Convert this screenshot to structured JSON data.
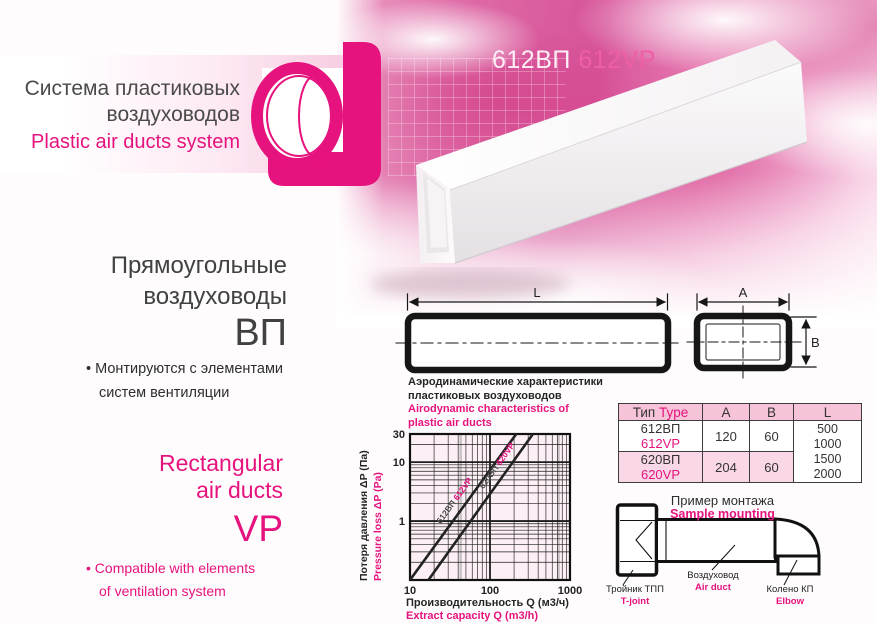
{
  "colors": {
    "accent": "#e6127d",
    "title_pink": "#ee5fa5",
    "dark": "#414141"
  },
  "header": {
    "title_ru_1": "Система пластиковых",
    "title_ru_2": "воздуховодов",
    "title_en": "Plastic air ducts system"
  },
  "product_title": {
    "ru": "612ВП",
    "en": "612VP"
  },
  "left": {
    "ru": {
      "h1": "Прямоугольные",
      "h2": "воздуховоды",
      "code": "ВП",
      "b1": "• Монтируются с элементами",
      "b2": "систем вентиляции"
    },
    "en": {
      "h1": "Rectangular",
      "h2": "air ducts",
      "code": "VP",
      "b1": "• Compatible with elements",
      "b2": "of ventilation system"
    }
  },
  "dimensions": {
    "L": "L",
    "A": "A",
    "B": "B"
  },
  "chart": {
    "title_ru1": "Аэродинамические характеристики",
    "title_ru2": "пластиковых воздуховодов",
    "title_en1": "Airodynamic characteristics of",
    "title_en2": "plastic air ducts"
  },
  "chart_data": {
    "type": "line",
    "title": "Аэродинамические характеристики пластиковых воздуховодов / Airodynamic characteristics of plastic air ducts",
    "x_axis": {
      "label_ru": "Производительность Q (м3/ч)",
      "label_en": "Extract capacity Q (m3/h)",
      "scale": "log",
      "range": [
        10,
        1000
      ],
      "ticks": [
        10,
        100,
        1000
      ]
    },
    "y_axis": {
      "label_ru": "Потеря давления ΔP (Па)",
      "label_en": "Pressure loss ΔP (Pa)",
      "scale": "log",
      "range": [
        0.1,
        30
      ],
      "ticks": [
        30,
        10,
        1
      ]
    },
    "grid": true,
    "legend_position": "on-line-labels",
    "series": [
      {
        "name_ru": "612ВП",
        "name_en": "612VP",
        "points": [
          [
            10,
            0.1
          ],
          [
            213,
            30
          ]
        ]
      },
      {
        "name_ru": "620ВП",
        "name_en": "620VP",
        "points": [
          [
            17,
            0.1
          ],
          [
            344,
            30
          ]
        ]
      }
    ]
  },
  "table": {
    "header": {
      "type_ru": "Тип",
      "type_en": "Type",
      "a": "A",
      "b": "B",
      "l": "L"
    },
    "rows": [
      {
        "ru": "612ВП",
        "en": "612VP",
        "a": "120",
        "b": "60"
      },
      {
        "ru": "620ВП",
        "en": "620VP",
        "a": "204",
        "b": "60"
      }
    ],
    "l_values": [
      "500",
      "1000",
      "1500",
      "2000"
    ]
  },
  "mounting": {
    "title_ru": "Пример монтажа",
    "title_en": "Sample mounting",
    "items": [
      {
        "ru": "Тройник ТПП",
        "en": "T-joint"
      },
      {
        "ru": "Воздуховод",
        "en": "Air duct"
      },
      {
        "ru": "Колено КП",
        "en": "Elbow"
      }
    ]
  }
}
